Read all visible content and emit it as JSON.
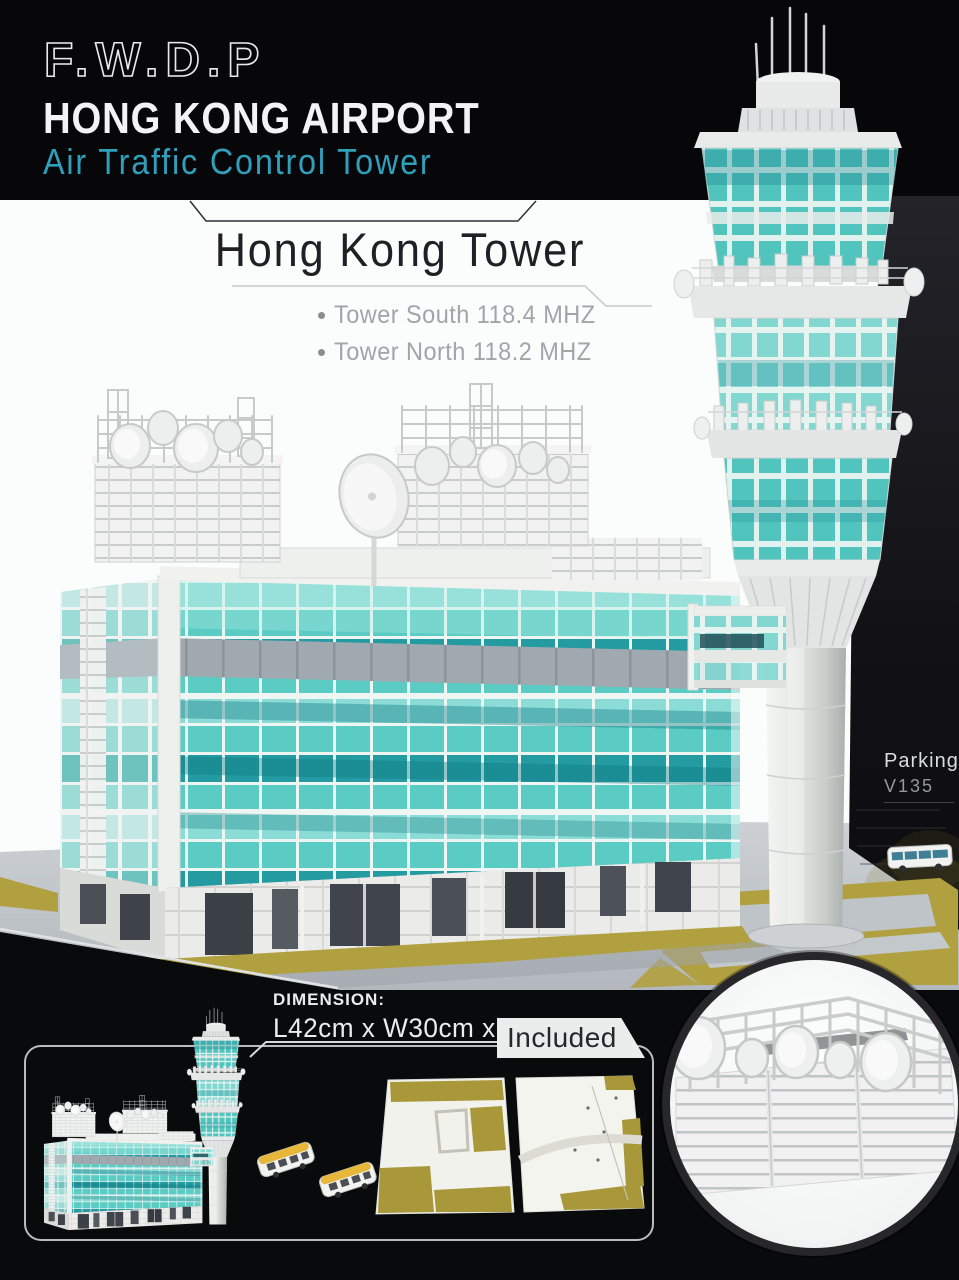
{
  "header": {
    "logo": "F.W.D.P",
    "title": "HONG KONG AIRPORT",
    "subtitle": "Air Traffic Control Tower"
  },
  "product": {
    "title": "Hong Kong Tower",
    "specs": [
      {
        "label": "Tower South 118.4 MHZ"
      },
      {
        "label": "Tower North 118.2 MHZ"
      }
    ]
  },
  "photo": {
    "subject": "model of Hong Kong airport air traffic control tower and terminal building",
    "parking_sign": {
      "line1": "Parking",
      "line2": "V135"
    }
  },
  "panel": {
    "dimension_label": "DIMENSION:",
    "dimension_value": "L42cm x W30cm x H25cm",
    "included_label": "Included"
  },
  "colors": {
    "accent_teal": "#2f9fbb",
    "glass_teal": "#4fc8c0",
    "glass_dark_teal": "#239ba1",
    "grass_olive": "#b1a03f",
    "bus_yellow": "#e7b73a",
    "background_black": "#0a0a0c",
    "sign_text": "#dcdde0"
  }
}
